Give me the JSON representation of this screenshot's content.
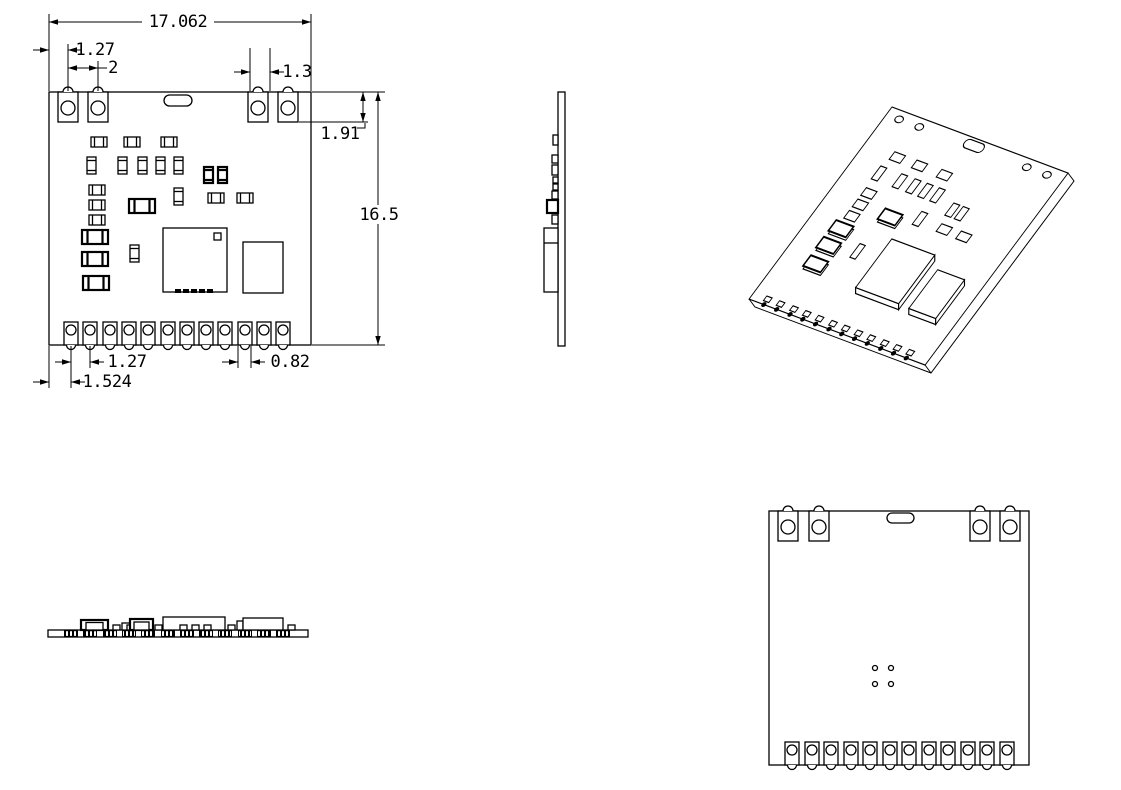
{
  "drawing": {
    "type": "engineering-drawing",
    "subject": "castellated RF PCB module - package outline views",
    "dims": {
      "overall_width": "17.062",
      "top_edge_offset": "1.27",
      "top_pad_pitch": "2",
      "top_right_gap": "1.3",
      "top_pad_length": "1.91",
      "overall_height": "16.5",
      "bottom_pad_pitch": "1.27",
      "bottom_pad_width": "0.82",
      "bottom_edge_offset": "1.524"
    }
  }
}
